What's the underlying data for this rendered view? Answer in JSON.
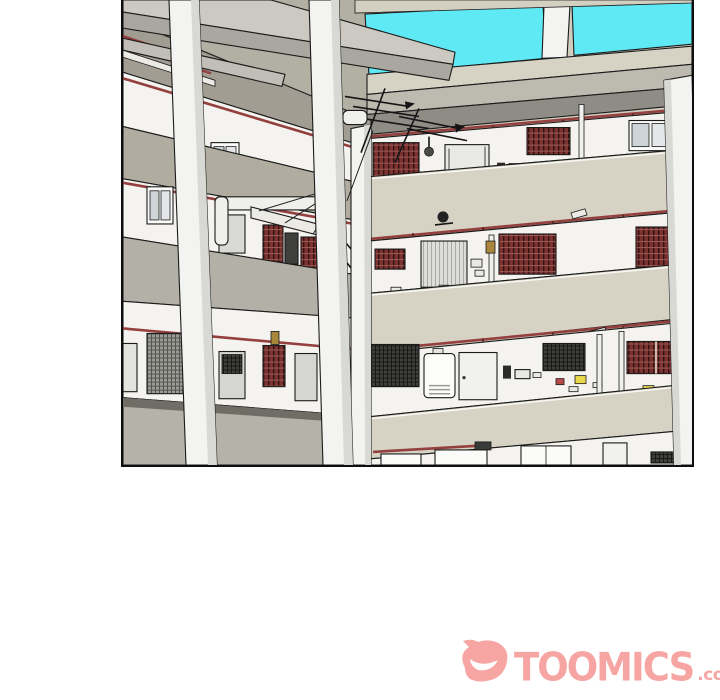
{
  "page": {
    "width": 720,
    "height": 700,
    "background": "#ffffff"
  },
  "panel": {
    "kind": "webtoon-background-panel",
    "description": "3D line-art view of an apartment building inner courtyard: cyan sky past roof beams at top, three corridor floors with red laundry-rail pipes, lattice and mesh windows, doors, water heater, gas pipes, TV antennas, and tall concrete pillars in the foreground.",
    "border_color": "#0e0e0e",
    "colors": {
      "sky": "#5fe9f4",
      "white_wall": "#f4f3ef",
      "parapet_beige": "#d6d2c4",
      "soffit_gray": "#8e8c85",
      "left_wing_gray": "#b2afa3",
      "railing_pipe_red": "#94403e",
      "lattice_window": "#7c3230",
      "mesh_window": "#3f3f3d",
      "pillar_white": "#f3f3f1",
      "outline": "#1b1b1b"
    },
    "scene": {
      "floors_visible": 4,
      "foreground_pillars": 3,
      "fixtures": [
        "red railing pipes",
        "lattice windows",
        "mesh windows",
        "roller shutter",
        "cctv camera",
        "water heater",
        "gas pipes with valves",
        "tv antennas",
        "drying rack",
        "vent fan"
      ]
    }
  },
  "watermark": {
    "brand": "TOOMICS",
    "suffix": ".com",
    "color": "#f6a5a2",
    "icon": "devil-face"
  }
}
